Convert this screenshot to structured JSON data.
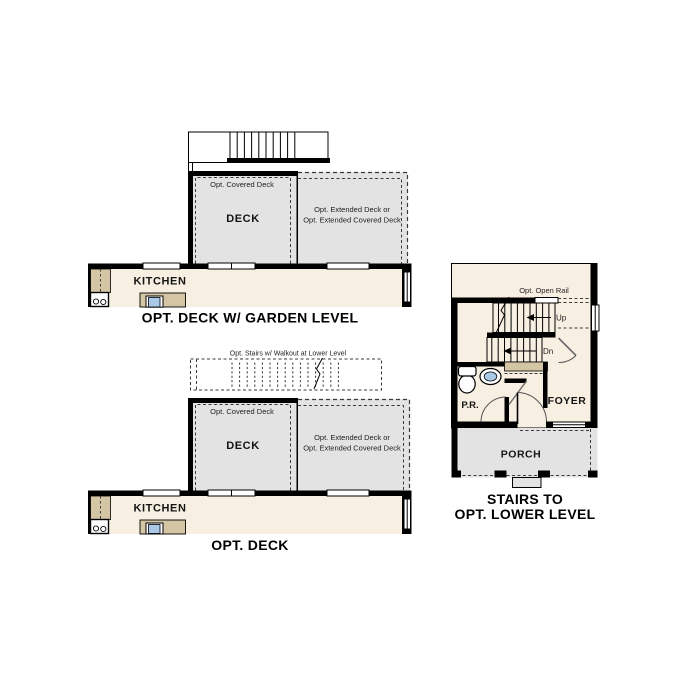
{
  "page": {
    "background": "#ffffff"
  },
  "colors": {
    "wall": "#000000",
    "deck_fill": "#e3e3e3",
    "interior_fill": "#f7efe1",
    "counter_fill": "#d4c5a5",
    "sink_fill": "#a9c9e6",
    "porch_fill": "#e3e3e3",
    "text": "#141414"
  },
  "icons": {
    "toilet": "toilet-icon",
    "sink": "sink-icon",
    "cooktop": "cooktop-icon",
    "stairs": "stairs-icon"
  },
  "plans": {
    "garden_level": {
      "title": "OPT. DECK W/ GARDEN LEVEL",
      "labels": {
        "covered_deck": "Opt. Covered Deck",
        "deck": "DECK",
        "extended_deck_line1": "Opt. Extended Deck or",
        "extended_deck_line2": "Opt. Extended Covered Deck",
        "kitchen": "KITCHEN"
      }
    },
    "opt_deck": {
      "title": "OPT. DECK",
      "labels": {
        "opt_stairs": "Opt. Stairs w/ Walkout at Lower Level",
        "covered_deck": "Opt. Covered Deck",
        "deck": "DECK",
        "extended_deck_line1": "Opt. Extended Deck or",
        "extended_deck_line2": "Opt. Extended Covered Deck",
        "kitchen": "KITCHEN"
      }
    },
    "lower_level_stairs": {
      "title_line1": "STAIRS TO",
      "title_line2": "OPT. LOWER LEVEL",
      "labels": {
        "open_rail": "Opt. Open Rail",
        "up": "Up",
        "down": "Dn",
        "powder_room": "P.R.",
        "foyer": "FOYER",
        "porch": "PORCH"
      }
    }
  }
}
